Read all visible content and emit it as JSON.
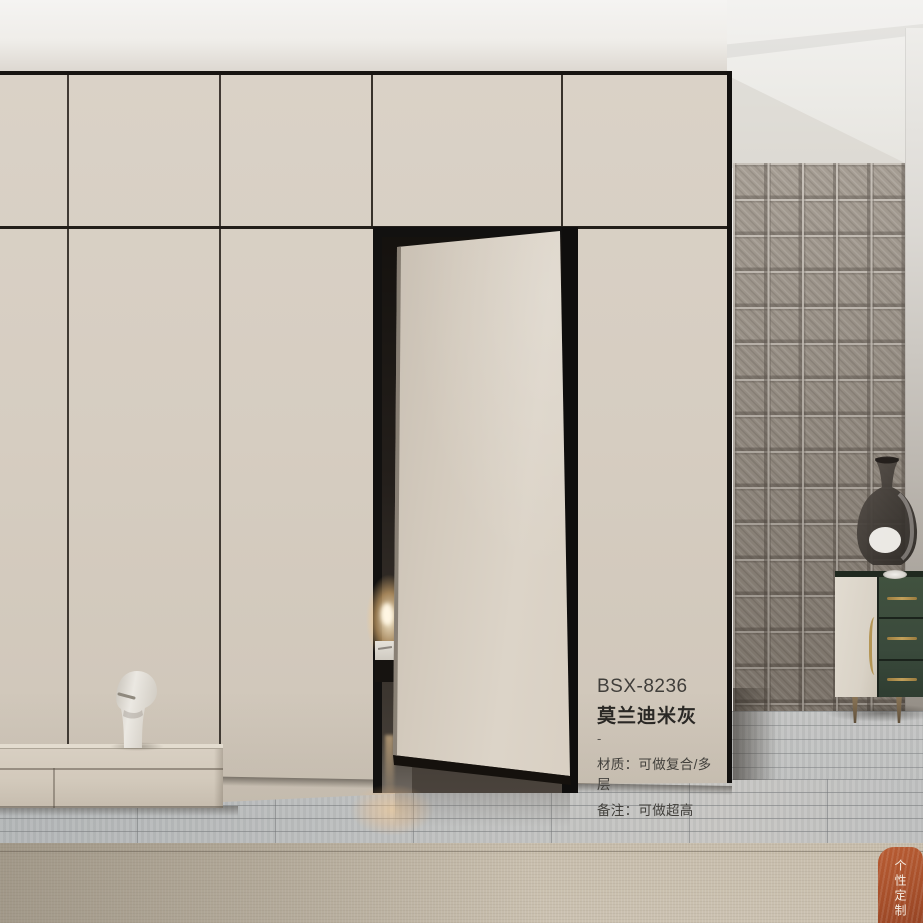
{
  "product_card": {
    "model": "BSX-8236",
    "color_name": "莫兰迪米灰",
    "divider": "-",
    "material_line": "材质：可做复合/多层",
    "note_line": "备注：可做超高"
  },
  "corner_badge": {
    "text": "个性定制 品质"
  },
  "palette": {
    "wardrobe_beige": "#d5ccc0",
    "door_beige": "#d8cfc2",
    "trim_black": "#161412",
    "tile_wall_gray": "#9c9388",
    "sideboard_green": "#3a4a3c",
    "handle_gold": "#b49554",
    "floor_gray": "#bdbfbf",
    "rug_beige": "#c9bfae",
    "badge_orange": "#a64f2a",
    "lamp_glow": "#ffcb82"
  }
}
